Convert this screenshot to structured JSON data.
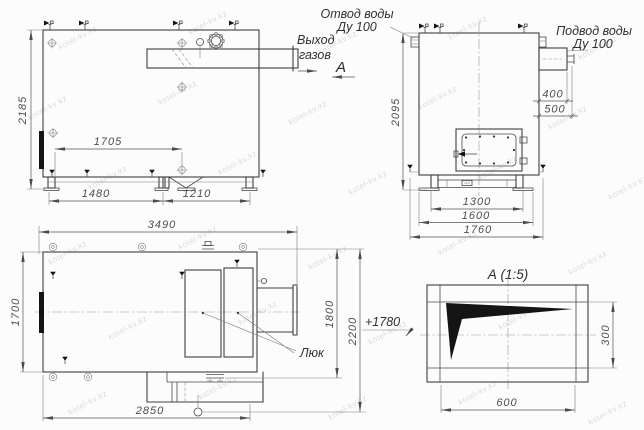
{
  "watermark": {
    "text": "kotel-kv.kz"
  },
  "side": {
    "gas_label_1": "Выход",
    "gas_label_2": "газов",
    "section_mark": "А",
    "dim_height": "2185",
    "dim_inner": "1705",
    "dim_span_left": "1480",
    "dim_span_right": "1210"
  },
  "front": {
    "water_outlet": "Отвод воды",
    "water_outlet_dn": "Ду 100",
    "water_inlet": "Подвод воды",
    "water_inlet_dn": "Ду 100",
    "dim_height": "2095",
    "dim_inlet_1": "400",
    "dim_inlet_2": "500",
    "dim_base_1": "1300",
    "dim_base_2": "1600",
    "dim_base_3": "1760"
  },
  "plan": {
    "hatch_label": "Люк",
    "elevation_mark": "+1780",
    "dim_length": "3490",
    "dim_width": "1700",
    "dim_bottom": "2850",
    "dim_right_inner": "1800",
    "dim_right_outer": "2200"
  },
  "detail": {
    "title": "А (1:5)",
    "dim_height": "300",
    "dim_width": "600"
  }
}
